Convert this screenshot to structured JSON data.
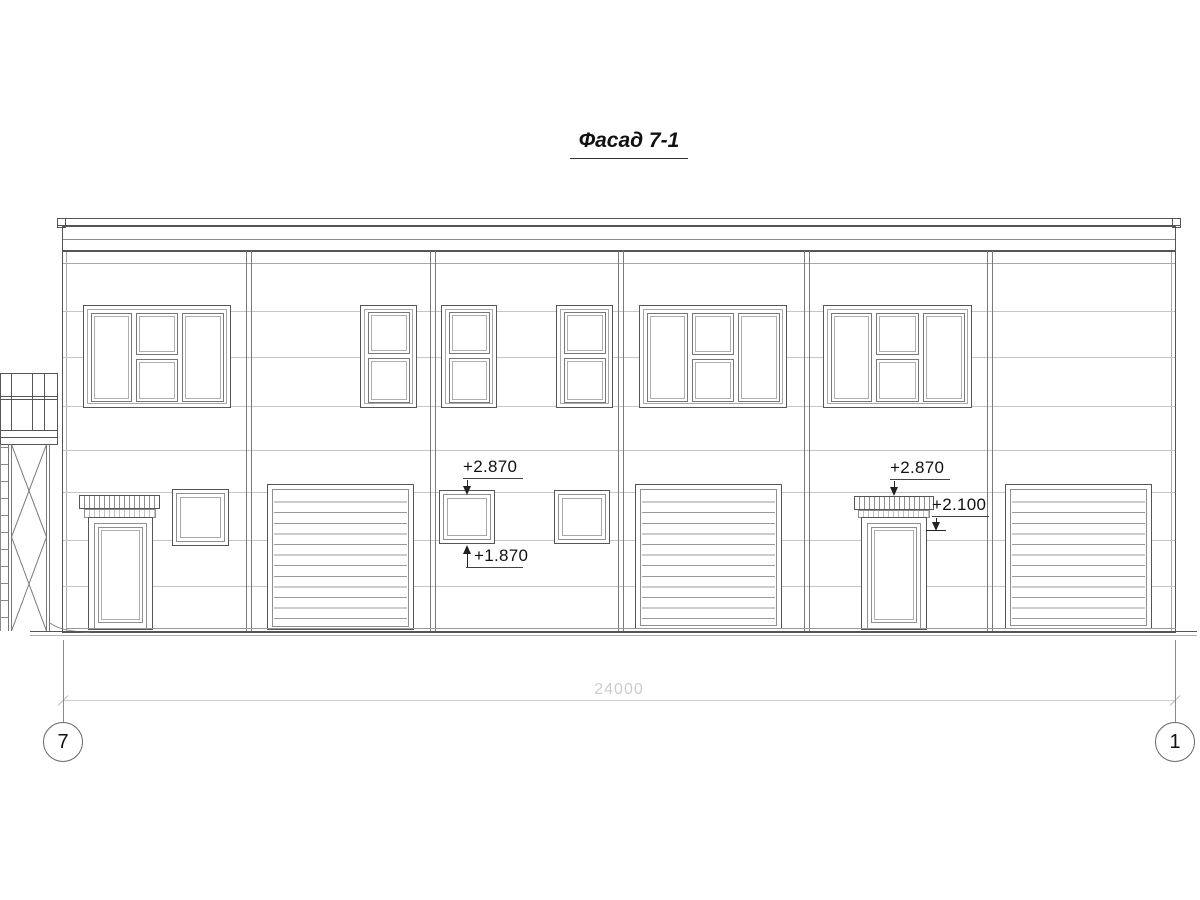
{
  "title": "Фасад 7-1",
  "levels": {
    "mid_window_top": "+2.870",
    "mid_window_bottom": "+1.870",
    "right_canopy_top": "+2.870",
    "right_canopy_underside": "+2.100"
  },
  "dimension": {
    "total_width": "24000"
  },
  "grid": {
    "left_axis": "7",
    "right_axis": "1"
  },
  "colors": {
    "background": "#ffffff",
    "line_primary": "#555555",
    "line_secondary": "#8f8f8f",
    "panel_joint": "#c6c6c6",
    "dimension_line": "#cccccc",
    "annotation_text": "#111111"
  }
}
